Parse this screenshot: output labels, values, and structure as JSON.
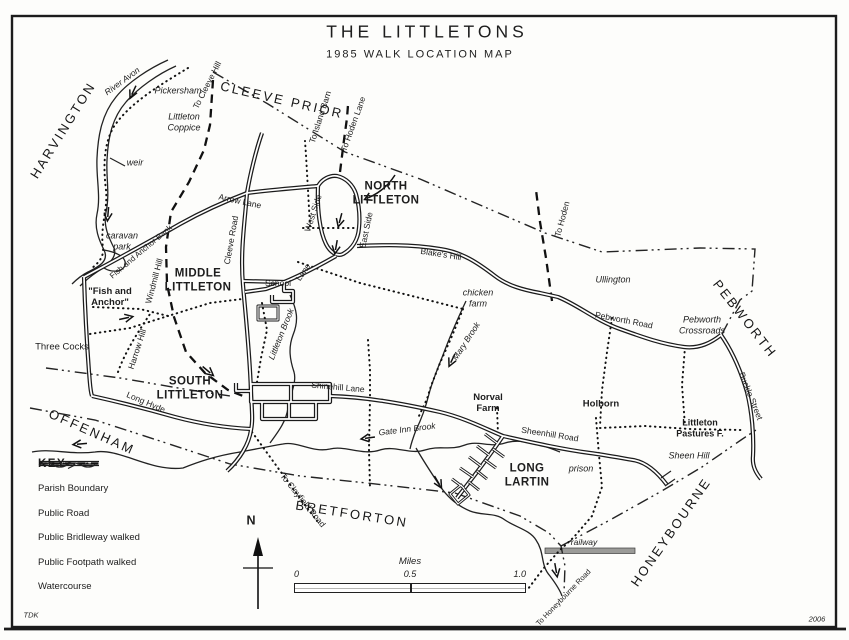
{
  "frame": {
    "title": "THE LITTLETONS",
    "subtitle": "1985 WALK LOCATION MAP",
    "cartographer": "TDK",
    "year": "2006"
  },
  "compass": {
    "label": "N"
  },
  "scale_bar": {
    "caption": "Miles",
    "ticks": [
      "0",
      "0.5",
      "1.0"
    ]
  },
  "key": {
    "heading": "KEY",
    "items": [
      {
        "symbol": "parish-boundary-line",
        "label": "Parish Boundary"
      },
      {
        "symbol": "public-road-line",
        "label": "Public Road"
      },
      {
        "symbol": "public-bridleway-line",
        "label": "Public Bridleway walked"
      },
      {
        "symbol": "public-footpath-line",
        "label": "Public Footpath walked"
      },
      {
        "symbol": "watercourse-line",
        "label": "Watercourse"
      }
    ]
  },
  "areas": {
    "harvington": "HARVINGTON",
    "cleeve_prior": "CLEEVE PRIOR",
    "offenham": "OFFENHAM",
    "bretforton": "BRETFORTON",
    "honeybourne": "HONEYBOURNE",
    "pebworth": "PEBWORTH"
  },
  "villages": {
    "north_littleton": [
      "NORTH",
      "LITTLETON"
    ],
    "middle_littleton": [
      "MIDDLE",
      "LITTLETON"
    ],
    "south_littleton": [
      "SOUTH",
      "LITTLETON"
    ],
    "long_lartin": [
      "LONG",
      "LARTIN"
    ]
  },
  "places": {
    "pickersham": "Pickersham",
    "littleton_coppice": [
      "Littleton",
      "Coppice"
    ],
    "weir": "weir",
    "caravan_park": [
      "caravan",
      "park"
    ],
    "fish_and_anchor": [
      "\"Fish and",
      "Anchor\""
    ],
    "three_cocks": "Three Cocks",
    "school": "School",
    "chicken_farm": [
      "chicken",
      "farm"
    ],
    "ullington": "Ullington",
    "pebworth_crossroads": [
      "Pebworth",
      "Crossroads"
    ],
    "norval_farm": [
      "Norval",
      "Farm"
    ],
    "holborn": "Holborn",
    "littleton_pastures": [
      "Littleton",
      "Pastures F."
    ],
    "sheen_hill": "Sheen Hill",
    "prison": "prison",
    "railway": "railway"
  },
  "roads": {
    "arrow_lane": "Arrow Lane",
    "cleeve_road": "Cleeve Road",
    "west_side": "West Side",
    "east_side": "East Side",
    "lane": "Lane",
    "blakes_hill": "Blake's Hill",
    "pebworth_road": "Pebworth Road",
    "buckle_street": "Buckle Street",
    "shinehill_lane": "Shinehill Lane",
    "sheenhill_road": "Sheenhill Road",
    "long_hyde": "Long Hyde",
    "harrow_hill": "Harrow Hill",
    "windmill_hill": "Windmill Hill",
    "fish_and_anchor_bank": "Fish and Anchor Bank",
    "to_cleeve_hill": "To Cleeve Hill",
    "to_island_barn": "To Island Barn",
    "to_hoden_lane": "To Hoden Lane",
    "to_hoden": "To Hoden",
    "to_clayfield_road": "To Clayfield Road",
    "to_honeybourne_road": "To Honeybourne Road"
  },
  "water": {
    "river_avon": "River Avon",
    "littleton_brook": "Littleton Brook",
    "mary_brook": "Mary Brook",
    "gate_inn_brook": "Gate Inn Brook"
  }
}
